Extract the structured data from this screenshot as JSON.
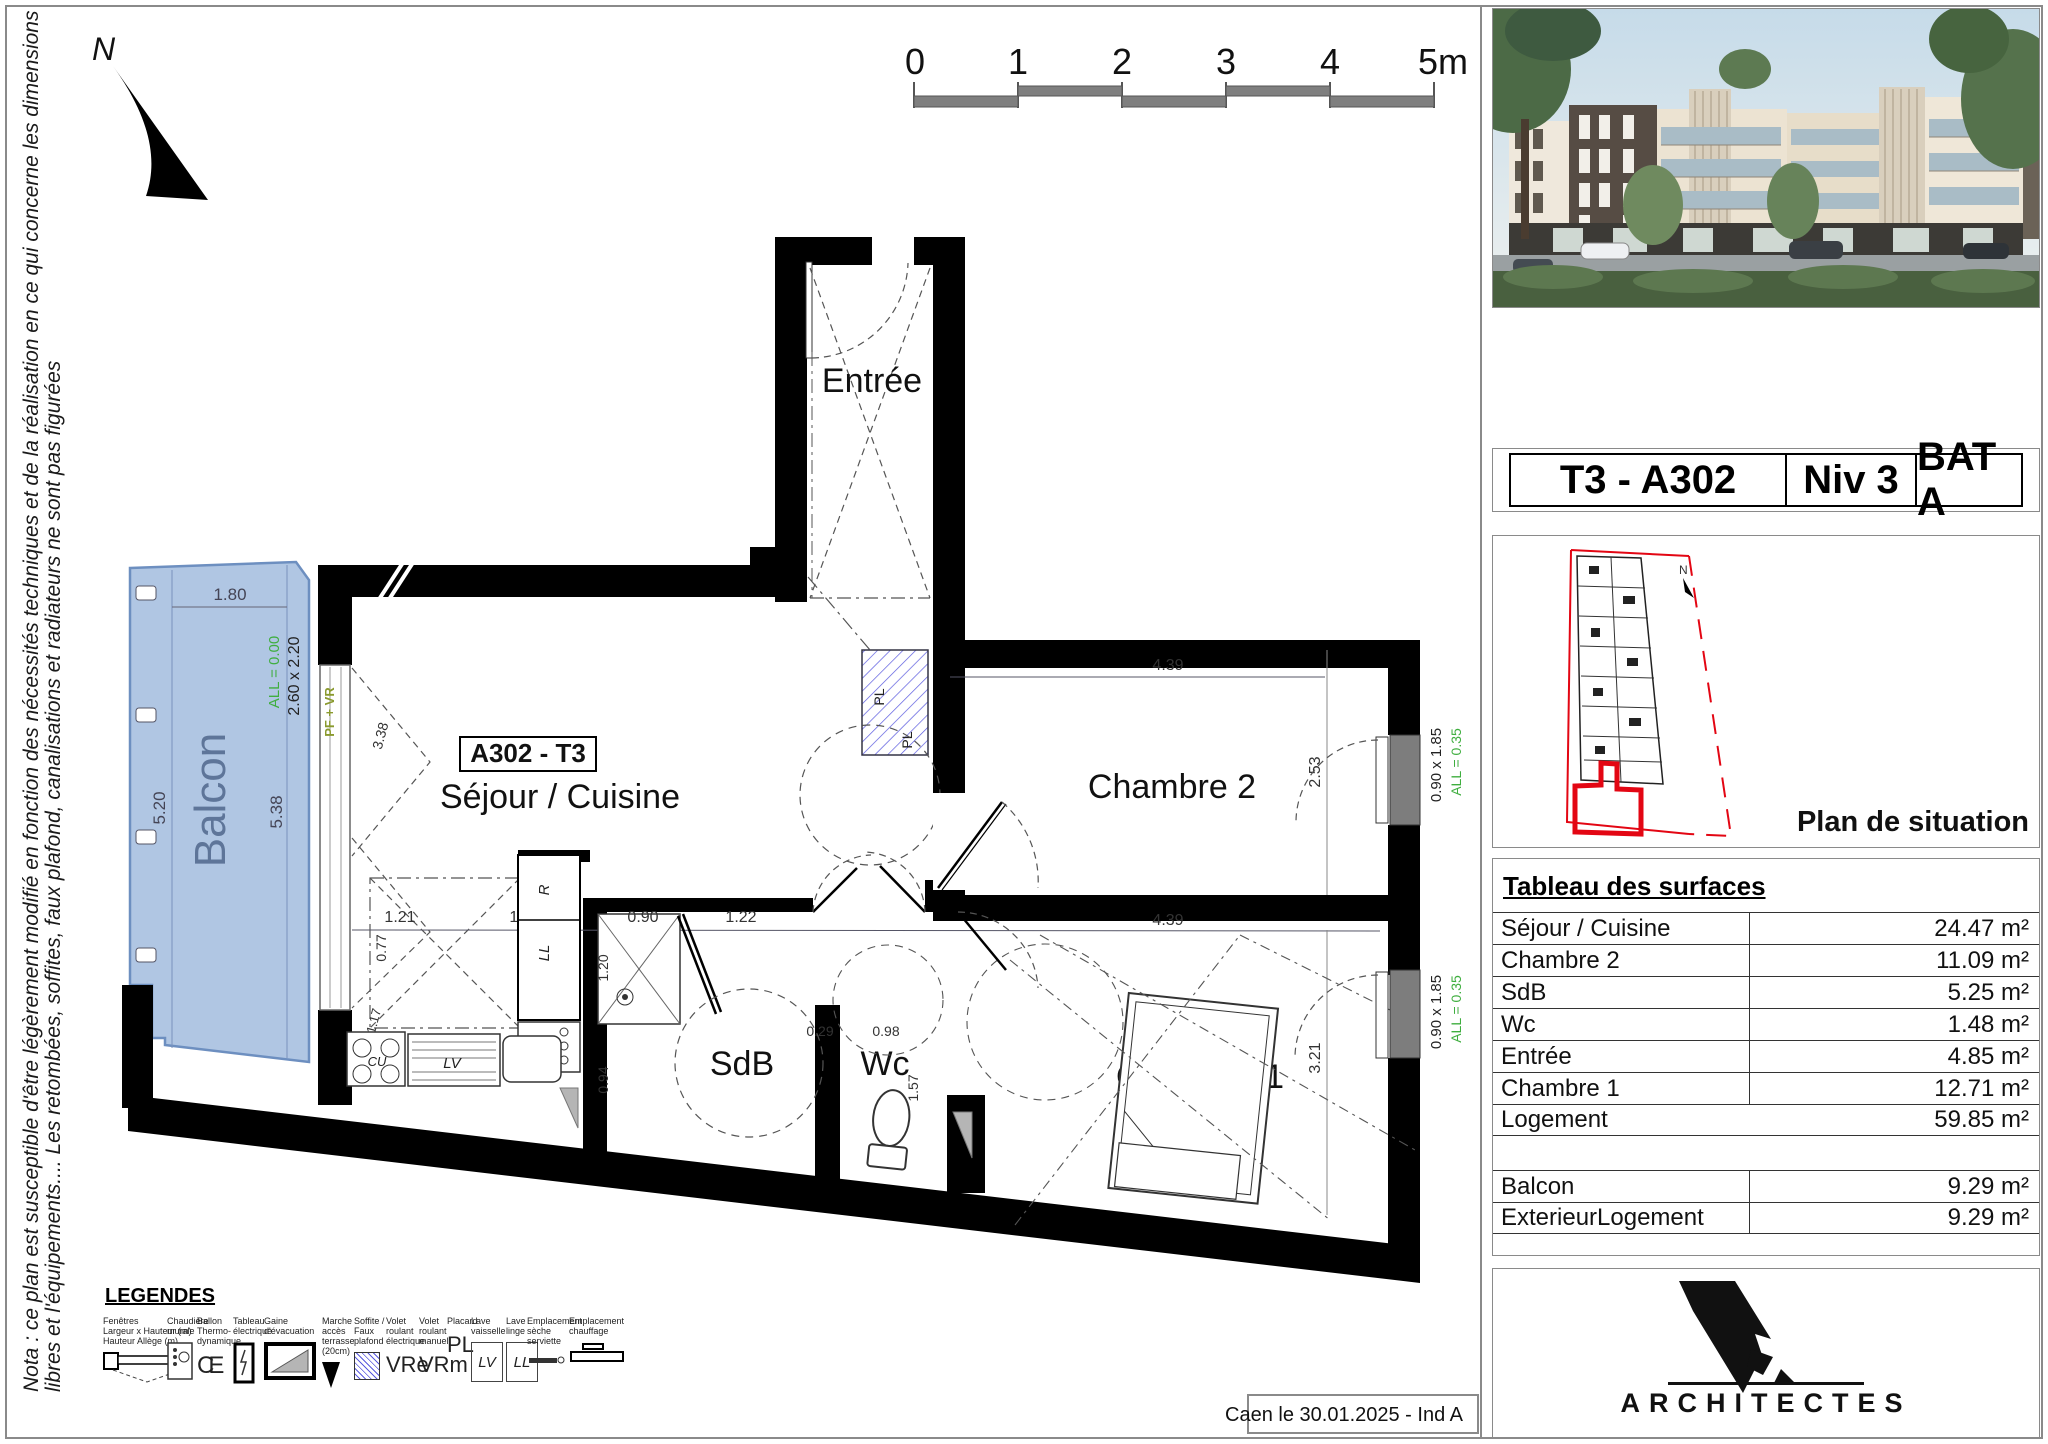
{
  "colors": {
    "balcony_fill": "#a9c1e1",
    "balcony_text": "#5e7599",
    "green_annotation": "#3fae3f",
    "olive_annotation": "#8a9a2e",
    "site_red": "#e30613",
    "wall_black": "#000000",
    "window_gray": "#7d7d7d"
  },
  "nota": {
    "line1": "Nota : ce plan est susceptible d'être légèrement modifié en fonction des nécessités techniques et de la réalisation en ce qui concerne les dimensions",
    "line2": "libres et l'équipements.... Les retombées, soffites, faux plafond, canalisations et radiateurs ne sont pas figurées"
  },
  "north": {
    "label": "N"
  },
  "scale_bar": {
    "labels": [
      "0",
      "1",
      "2",
      "3",
      "4",
      "5m"
    ]
  },
  "plan": {
    "unit_box": "A302 - T3",
    "rooms": {
      "entree": "Entrée",
      "sejour": "Séjour / Cuisine",
      "chambre2": "Chambre 2",
      "chambre1": "Chambre 1",
      "sdb": "SdB",
      "wc": "Wc",
      "balcon": "Balcon"
    },
    "dims": {
      "d180": "1.80",
      "d520": "5.20",
      "d538": "5.38",
      "all000": "ALL = 0.00",
      "w260": "2.60 x 2.20",
      "pfvr": "PF + VR",
      "d338": "3.38",
      "d121": "1.21",
      "d077": "0.77",
      "d117": "1.17",
      "d125a": "1.25",
      "d090": "0.90",
      "d122": "1.22",
      "d120": "1.20",
      "d094": "0.94",
      "d125b": "1.25",
      "d029": "0.29",
      "d098": "0.98",
      "d157": "1.57",
      "d439a": "4.39",
      "d253": "2.53",
      "d439b": "4.39",
      "d321": "3.21",
      "w090a": "0.90 x 1.85",
      "all035a": "ALL = 0.35",
      "w090b": "0.90 x 1.85",
      "all035b": "ALL = 0.35",
      "r": "R",
      "ll": "LL",
      "cu": "CU",
      "lv": "LV",
      "pl1": "PL",
      "pl2": "PL"
    }
  },
  "title_block": {
    "unit": "T3 - A302",
    "level": "Niv 3",
    "building": "BAT A"
  },
  "situation": {
    "label": "Plan de situation",
    "north_label": "N"
  },
  "surface_table": {
    "title": "Tableau des surfaces",
    "rows": [
      {
        "label": "Séjour / Cuisine",
        "value": "24.47 m²"
      },
      {
        "label": "Chambre 2",
        "value": "11.09 m²"
      },
      {
        "label": "SdB",
        "value": "5.25 m²"
      },
      {
        "label": "Wc",
        "value": "1.48 m²"
      },
      {
        "label": "Entrée",
        "value": "4.85 m²"
      },
      {
        "label": "Chambre 1",
        "value": "12.71 m²"
      }
    ],
    "logement_row": {
      "label": "Logement",
      "value": "59.85 m²"
    },
    "annex_rows": [
      {
        "label": "Balcon",
        "value": "9.29 m²"
      },
      {
        "label": "ExterieurLogement",
        "value": "9.29 m²"
      }
    ]
  },
  "legend": {
    "title": "LEGENDES",
    "items": [
      {
        "label": "Fenêtres\nLargeur x Hauteur (m)\nHauteur Allège (m)"
      },
      {
        "label": "Chaudière\nmurale"
      },
      {
        "label": "Ballon\nThermo-\ndynamique"
      },
      {
        "label": "Tableau\nélectrique"
      },
      {
        "label": "Gaine\nd'évacuation"
      },
      {
        "label": "Marche\naccès\nterrasse\n(20cm)"
      },
      {
        "label": "Soffite /\nFaux\nplafond"
      },
      {
        "label": "Volet\nroulant\nélectrique",
        "symbol_text": "VRe"
      },
      {
        "label": "Volet\nroulant\nmanuel",
        "symbol_text": "VRm"
      },
      {
        "label": "Placard",
        "symbol_text": "PL"
      },
      {
        "label": "Lave\nvaisselle",
        "symbol_text": "LV"
      },
      {
        "label": "Lave\nlinge",
        "symbol_text": "LL"
      },
      {
        "label": "Emplacement\nsèche\nserviette"
      },
      {
        "label": "Emplacement\nchauffage"
      }
    ]
  },
  "footer": {
    "date_line": "Caen le 30.01.2025 - Ind A"
  },
  "logo": {
    "name": "ARCHITECTES"
  }
}
